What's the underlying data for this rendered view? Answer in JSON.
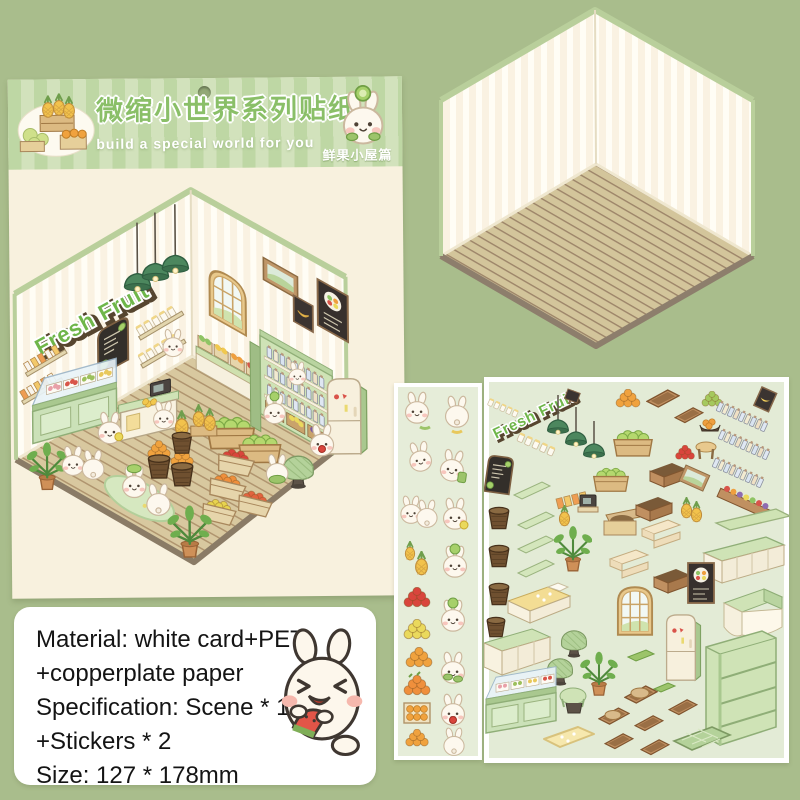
{
  "page": {
    "background": "#a9bd8c"
  },
  "product_card": {
    "header": {
      "title": "微缩小世界系列贴纸",
      "subtitle": "build a special world for you",
      "edition_label": "鲜果小屋篇",
      "stripe_dark": "#bed7a4",
      "stripe_light": "#d2e2bc",
      "title_color": "#8abf68",
      "icons": [
        "pineapple-crates-art",
        "bunny-kiwi-badge",
        "hang-hole"
      ]
    },
    "scene": {
      "sign_text": "Fresh Fruit",
      "wall_color": "#faf2e2",
      "floor_color": "#d8c89f",
      "items": [
        "fresh-fruit-sign",
        "pendant-lamps",
        "menu-blackboard",
        "juice-wall-shelves",
        "cup-wall-shelves",
        "arched-window",
        "landscape-frame",
        "banana-frame",
        "fruit-bowl-board",
        "bottle-shelf-unit",
        "fridge",
        "freezer-display-case",
        "checkout-counter",
        "fruit-display-back",
        "melon-crates",
        "orange-baskets",
        "pineapple-stand",
        "fruit-crates-front",
        "green-rug",
        "potted-plants",
        "green-pouf",
        "shopping-bunnies"
      ]
    }
  },
  "scene_card": {
    "wall_color": "#faf2e2",
    "floor_color": "#d3c59b",
    "trim_color": "#b9cf9b"
  },
  "sticker_strip": {
    "background": "#e6edd9",
    "items": [
      "bunny",
      "bunny-back",
      "bunny-shy",
      "bunny-with-bag",
      "bunny-pair",
      "bunny-eating-lemon",
      "pineapple-small",
      "pineapple-large",
      "bunny-kiwi-hat",
      "strawberry-pile",
      "lemon-pile",
      "bunny-kiwi-cheek",
      "orange-pile",
      "bunny-holding-greens",
      "persimmon-pile",
      "orange-crate",
      "bunny-crying",
      "bunny-sitting-back"
    ]
  },
  "sticker_sheet": {
    "background": "#e3ebd6",
    "sign_text": "Fresh Fruit",
    "items": [
      "fresh-fruit-sign",
      "cup-rows",
      "small-frame",
      "pendant-lamps",
      "orange-pile",
      "wood-trays",
      "green-pile",
      "bottle-garlands",
      "banana-frame",
      "fruit-shelf-row",
      "green-plank-long",
      "green-counter-long",
      "menu-blackboard",
      "baskets",
      "shelf-planks",
      "juice-box-row",
      "melon-crates",
      "cash-register",
      "pineapple",
      "potted-palm",
      "apple-crate",
      "open-boxes",
      "red-pile",
      "round-stool",
      "orange-bowl",
      "landscape-frame",
      "pineapple-pair",
      "cream-boxes",
      "fruit-bowl-board",
      "yellow-bed",
      "green-poufs",
      "arched-window",
      "fridge",
      "green-bench",
      "white-counter",
      "green-bookshelf",
      "monstera-plant",
      "green-mats",
      "round-table",
      "freezer-display-case",
      "toast-trays",
      "brown-trays",
      "yellow-rug",
      "green-diamond-rug"
    ]
  },
  "info_box": {
    "lines": [
      "Material: white card+PET",
      "+copperplate paper",
      "Specification: Scene * 1",
      "+Stickers * 2",
      "Size: 127 * 178mm"
    ],
    "icon": "watermelon-bunny"
  }
}
